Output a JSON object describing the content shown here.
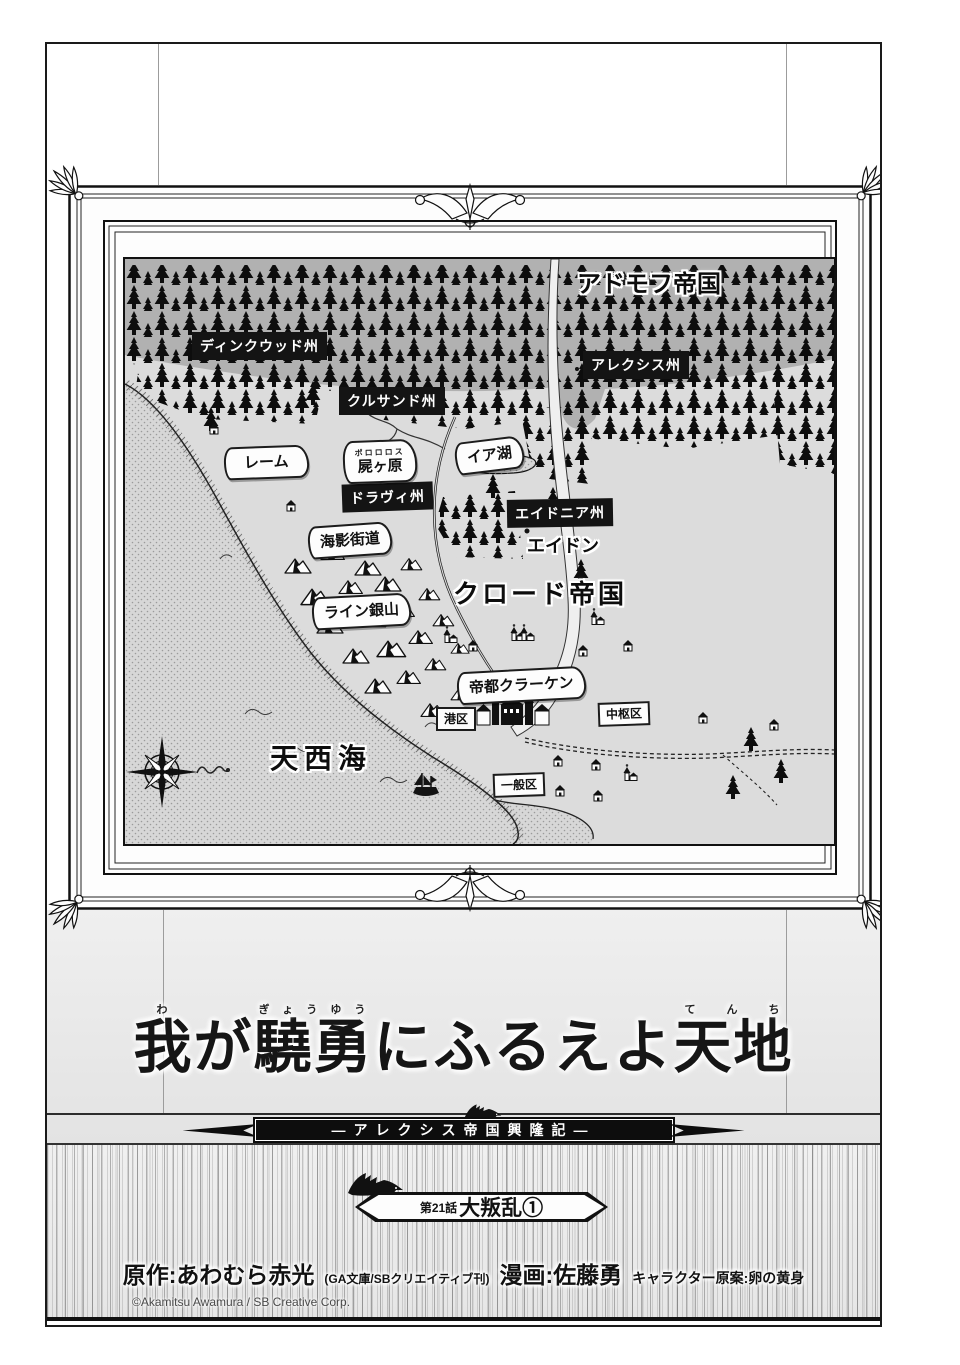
{
  "colors": {
    "page_bg": "#ffffff",
    "panel_border": "#1a1a1a",
    "wall_lower": "#e8e8e8",
    "map_land": "#dcdcdc",
    "map_north_region": "#b1b1b1",
    "forest": "#0d0d0d",
    "label_box_bg": "#141414",
    "label_box_text": "#ffffff",
    "sea_tone_dot": "#9b9b9b"
  },
  "icons": {
    "compass-rose-icon": "svg-8-point-star",
    "sailing-ship-icon": "svg-ship-silhouette",
    "dragon-icon": "svg-dragon-silhouette",
    "sea-serpent-icon": "svg-squiggle",
    "tree-icon": "svg-spruce-silhouette",
    "mountain-icon": "svg-peak",
    "house-icon": "svg-house",
    "church-icon": "svg-church-spire",
    "frame-shell-icon": "svg-scallop-fan",
    "frame-crest-icon": "svg-palmette"
  },
  "map": {
    "empires": {
      "north": "アドモフ帝国",
      "south": "クロード帝国"
    },
    "provinces": {
      "dinkwood": "ディンクウッド州",
      "kurusand": "クルサンド州",
      "alexis": "アレクシス州",
      "dravi": "ドラヴィ州",
      "eidonia": "エイドニア州"
    },
    "banners": {
      "rheme": "レーム",
      "shikabane": "屍ヶ原",
      "shikabane_furigana": "ポロロロス",
      "lake_ia": "イア湖",
      "umikage_road": "海影街道",
      "rhine_mine": "ライン銀山",
      "capital": "帝都クラーケン"
    },
    "towns": {
      "eidon": "エイドン"
    },
    "districts": {
      "port": "港区",
      "central": "中枢区",
      "general": "一般区"
    },
    "sea": {
      "name": "天西海"
    }
  },
  "title_block": {
    "t1": "我",
    "r1": "わ",
    "t2": "が",
    "t3": "驍勇",
    "r3": "ぎょうゆう",
    "t4": "にふるえよ",
    "t5": "天地",
    "r5": "てんち",
    "subtitle": "―アレクシス帝国興隆記―"
  },
  "chapter": {
    "number": "第21話",
    "name": "大叛乱①"
  },
  "credits": {
    "original_label": "原作:あわむら赤光",
    "publisher_note": "(GA文庫/SBクリエイティブ刊)",
    "art_label": "漫画:佐藤勇",
    "chara_label": "キャラクター原案:卵の黄身",
    "copyright": "©Akamitsu Awamura / SB Creative Corp."
  }
}
